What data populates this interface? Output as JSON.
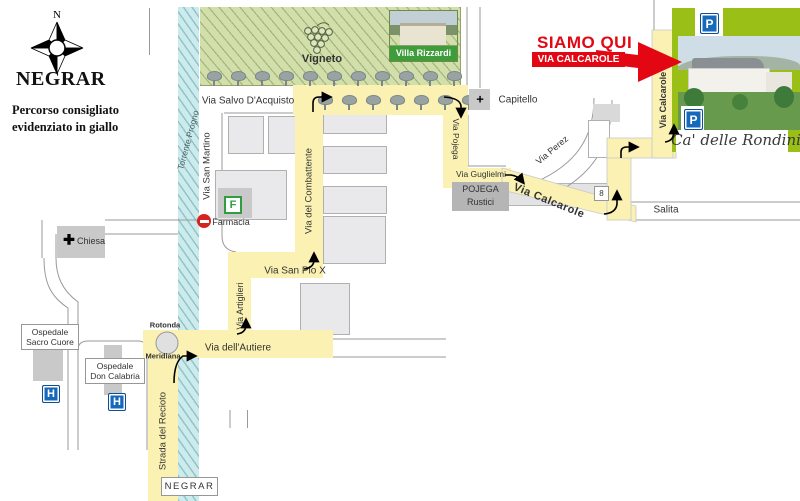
{
  "legend": {
    "north": "N",
    "title": "NEGRAR",
    "subtitle1": "Percorso consigliato",
    "subtitle2": "evidenziato in giallo"
  },
  "nature": {
    "vineyard": "Vigneto",
    "stream": "Torrente Progno"
  },
  "streets": {
    "salvo": "Via Salvo D'Acquisto",
    "san_martino": "Via San Martino",
    "combattente": "Via del Combattente",
    "pojega": "Via Pojega",
    "guglielmi": "Via Guglielmi",
    "calcarole_diag": "Via Calcarole",
    "calcarole_vert": "Via Calcarole",
    "perez": "Via Perez",
    "salita": "Salita",
    "san_pio": "Via San Pio X",
    "artiglieri": "Via Artiglieri",
    "autiere": "Via dell'Autiere",
    "recioto": "Strada del Recioto",
    "route_number": "8"
  },
  "pois": {
    "villa": "Villa Rizzardi",
    "capitello": "Capitello",
    "pojega_rustici1": "POJEGA",
    "pojega_rustici2": "Rustici",
    "farmacia": "Farmacia",
    "farmacia_letter": "F",
    "chiesa": "Chiesa",
    "osp_sacro1": "Ospedale",
    "osp_sacro2": "Sacro Cuore",
    "osp_don1": "Ospedale",
    "osp_don2": "Don Calabria",
    "hospital_letter": "H",
    "rotonda": "Rotonda",
    "meridiana": "Meridiana",
    "negrar_sign": "NEGRAR"
  },
  "destination": {
    "here": "SIAMO QUI",
    "address": "VIA CALCAROLE 16",
    "name": "Ca' delle Rondini",
    "parking_letter": "P"
  },
  "colors": {
    "route_yellow": "#FAF1B3",
    "stream_blue": "#CDEAEC",
    "vineyard_green": "#D2DFAB",
    "accent_red": "#E30613",
    "sign_blue": "#1668BB",
    "frame_green": "#9ABF16",
    "pharmacy_green": "#2F9E41",
    "villa_caption_green": "#3F9C3A"
  }
}
